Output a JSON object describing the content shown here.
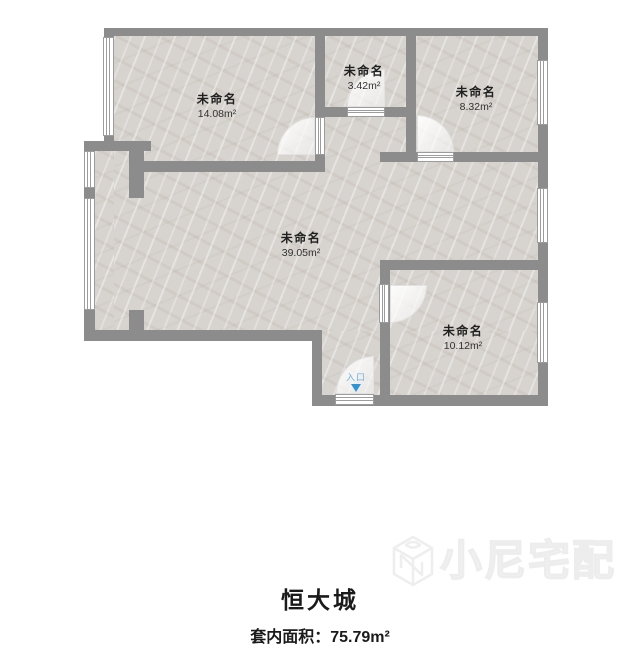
{
  "plan": {
    "title": "恒大城",
    "footer": {
      "area_label": "套内面积：",
      "area_value": "75.79m²"
    },
    "entrance": {
      "label": "入口",
      "arrow_icon": "down-arrow",
      "text_color": "#6fb3df",
      "arrow_color": "#2e96d5"
    },
    "rooms": [
      {
        "id": "top-left",
        "name": "未命名",
        "area": "14.08m²"
      },
      {
        "id": "top-middle",
        "name": "未命名",
        "area": "3.42m²"
      },
      {
        "id": "top-right",
        "name": "未命名",
        "area": "8.32m²"
      },
      {
        "id": "center",
        "name": "未命名",
        "area": "39.05m²"
      },
      {
        "id": "bottom-right",
        "name": "未命名",
        "area": "10.12m²"
      }
    ],
    "colors": {
      "wall": "#8c8c8c",
      "floor_base": "#d7d3ce",
      "text": "#1f1f1f"
    }
  },
  "watermark": {
    "brand": "小尼宅配",
    "logo": "cube-n-logo"
  }
}
